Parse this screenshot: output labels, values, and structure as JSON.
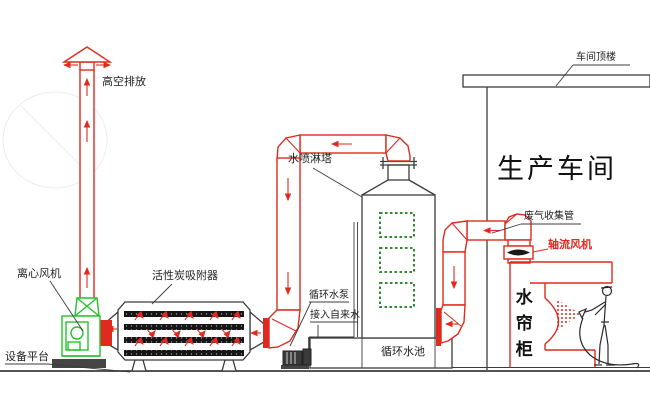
{
  "colors": {
    "pipe_red": "#e02a20",
    "fan_green": "#25c32a",
    "window_green": "#2e8b2e",
    "line_dark": "#3c3c3c"
  },
  "labels": {
    "high_discharge": "高空排放",
    "centrifugal_fan": "离心风机",
    "equipment_platform": "设备平台",
    "carbon_adsorber": "活性炭吸附器",
    "spray_tower": "水喷淋塔",
    "circulating_pump": "循环水泵",
    "tap_water": "接入自来水",
    "circulating_pool": "循环水池",
    "production_workshop": "生产车间",
    "workshop_roof": "车间顶楼",
    "gas_collection_pipe": "废气收集管",
    "axial_fan": "轴流风机",
    "water_curtain_cabinet": "水帘柜"
  }
}
